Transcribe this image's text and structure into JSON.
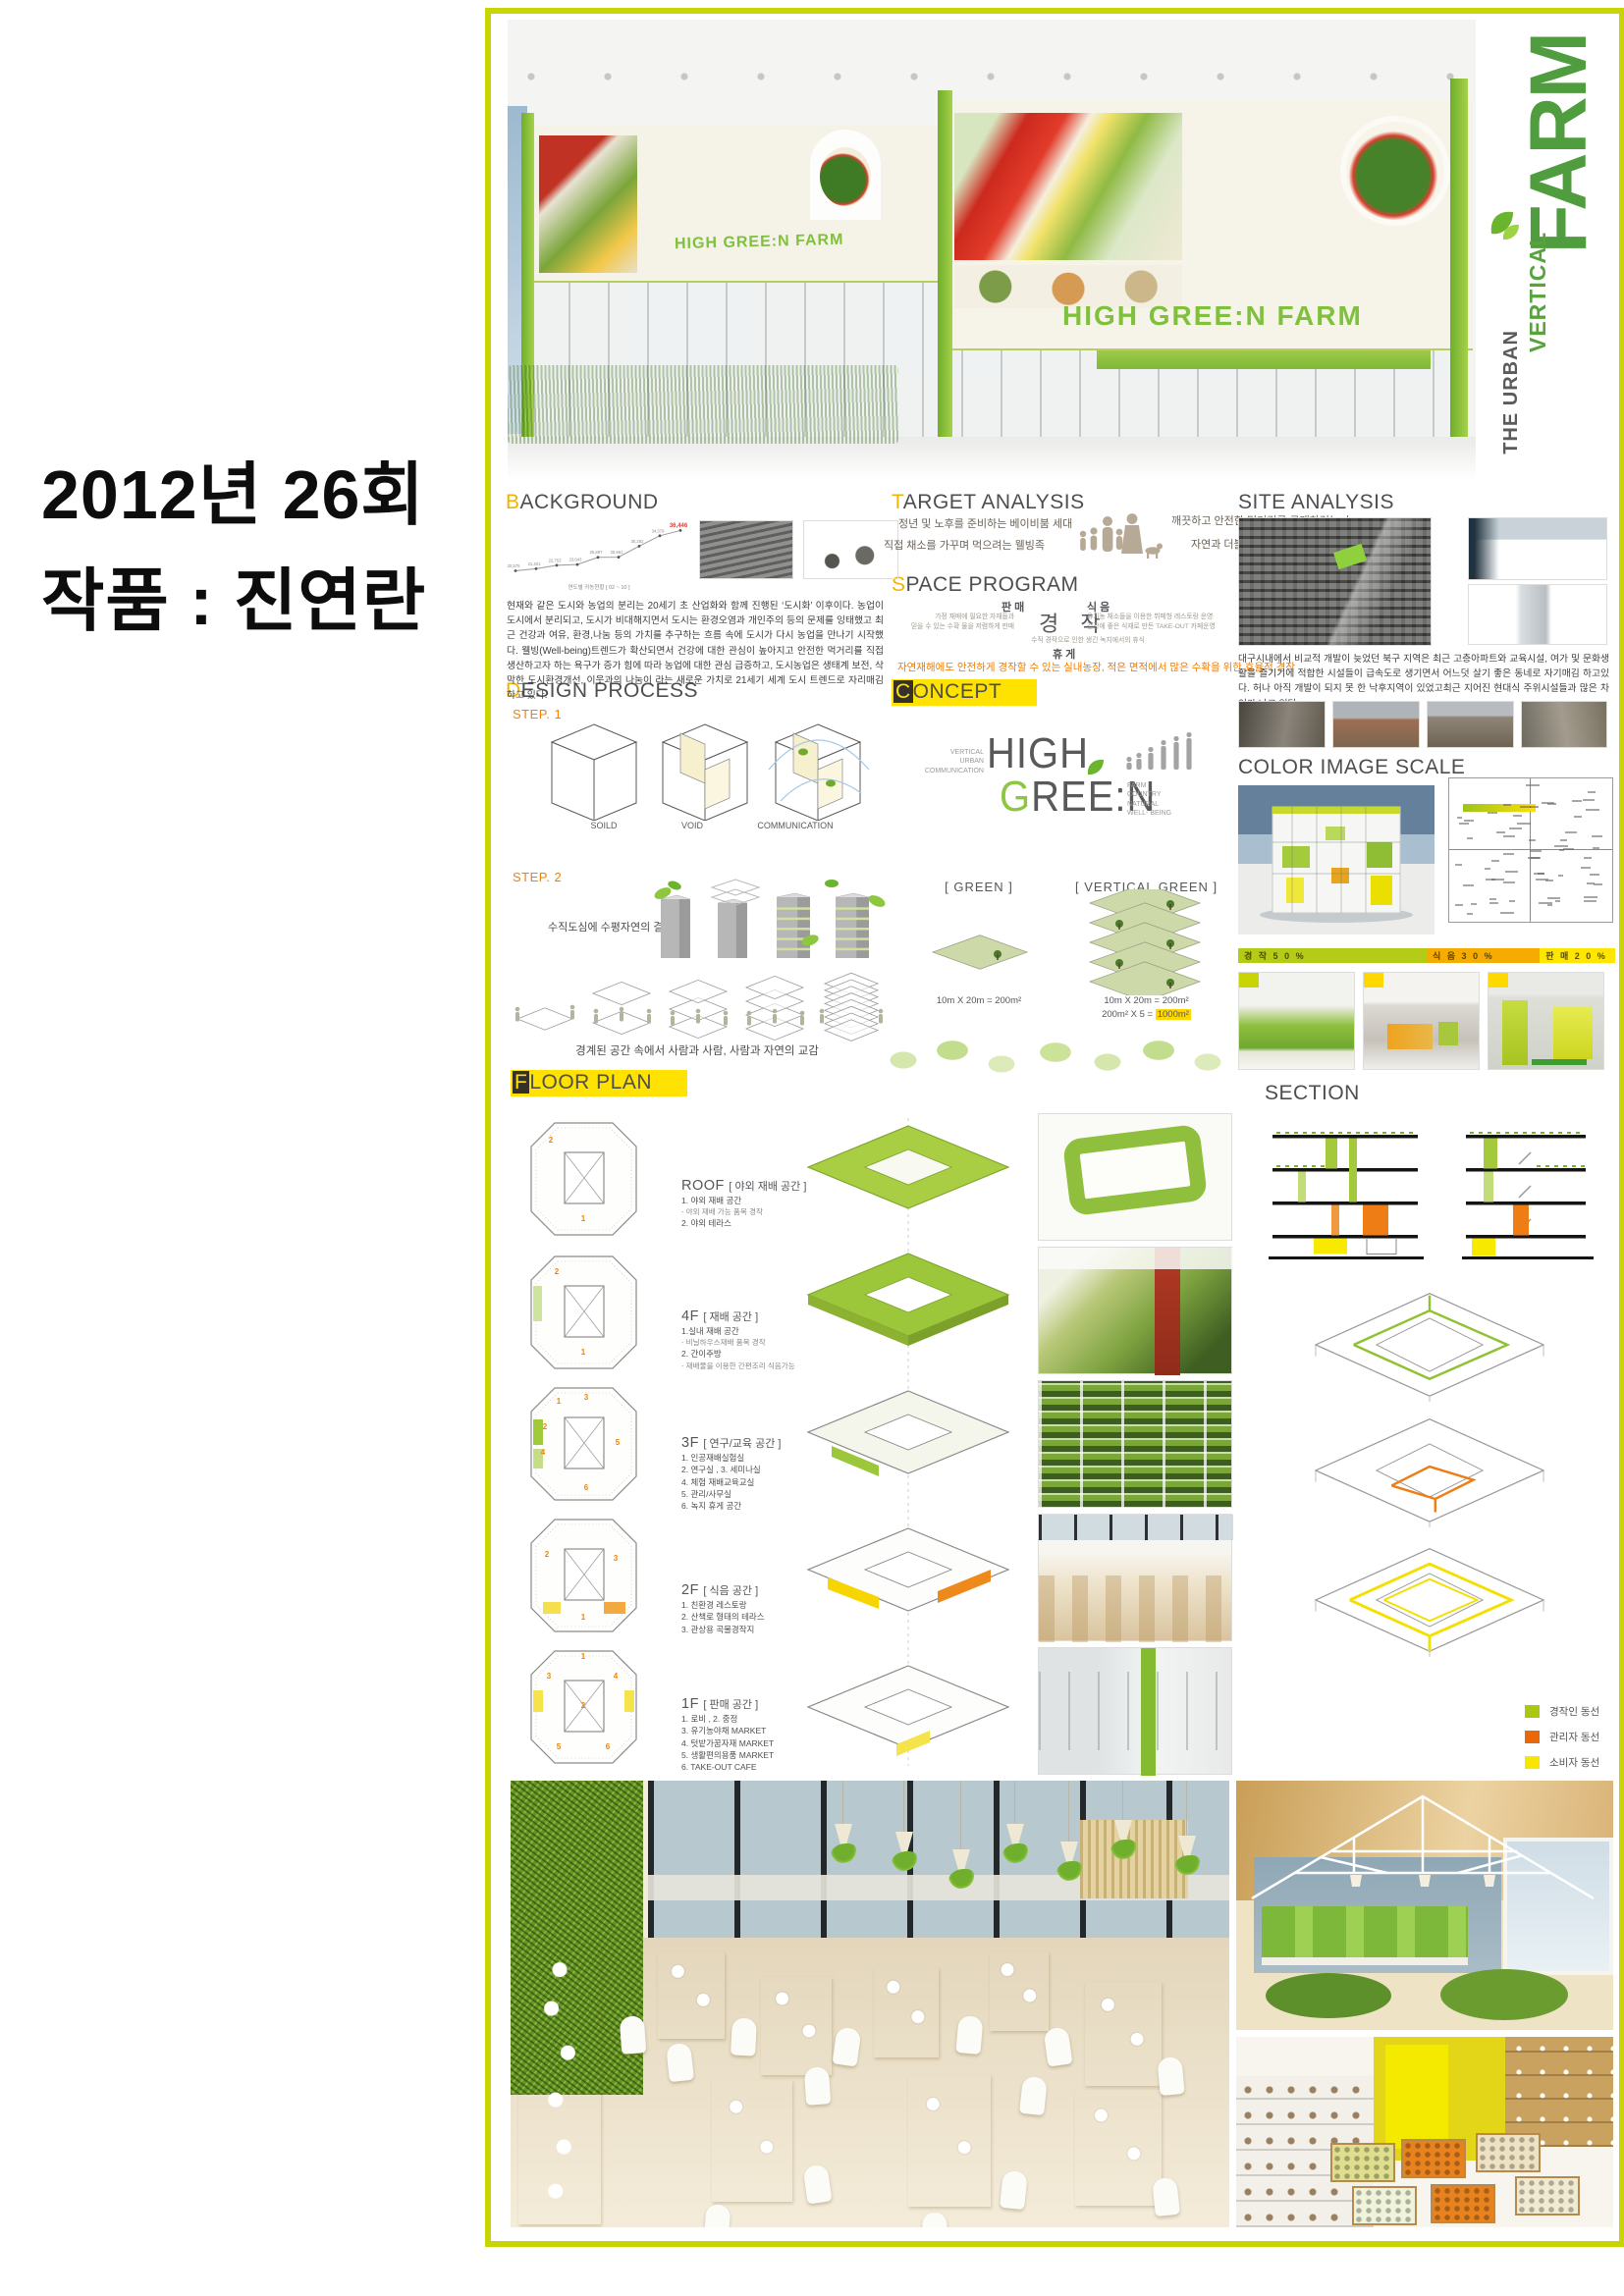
{
  "page": {
    "year_title": "2012년 26회",
    "work_title": "작품 : 진연란"
  },
  "hero": {
    "banner_text_left": "HIGH GREE:N FARM",
    "banner_text_right": "HIGH GREE:N FARM",
    "side_title": {
      "line1": "THE URBAN",
      "line2": "VERTICAL",
      "line3": "FARM"
    }
  },
  "background": {
    "title": "BACKGROUND",
    "chart_caption": "연도별 귀농현황 [ 02 ~ 10 ]",
    "body": "현재와 같은 도시와 농업의 분리는 20세기 초 산업화와 함께 진행된 ‘도시화’ 이후이다. 농업이 도시에서 분리되고, 도시가 비대해지면서 도시는 환경오염과 개인주의 등의 문제를 잉태했고 최근 건강과 여유, 환경,나눔 등의 가치를 추구하는 흐름 속에 도시가 다시 농업을 만나기 시작했다. 웰빙(Well-being)트렌드가 확산되면서 건강에 대한 관심이 높아지고 안전한 먹거리를 직접생산하고자 하는 욕구가 증가 힘에 따라 농업에 대한 관심 급증하고, 도시농업은 생태계 보전, 삭막한 도시환경개선, 이웃과의 나눔이 라는 새로운 가치로 21세기  세계 도시 트렌드로 자리매김 하고 있다."
  },
  "chart_data": {
    "type": "line",
    "title": "연도별 귀농현황 [ 02 ~ 10 ]",
    "x": [
      "02",
      "03",
      "04",
      "05",
      "06",
      "07",
      "08",
      "09",
      "10"
    ],
    "values": [
      20575,
      21401,
      22753,
      23043,
      25897,
      25961,
      30292,
      34379,
      36446
    ],
    "labels": [
      "20,575",
      "21,401",
      "22,753",
      "23,043",
      "25,897",
      "25,961",
      "30,292",
      "34,379",
      "36,446"
    ],
    "ylim": [
      20000,
      37000
    ],
    "grid": false,
    "last_label_color": "#e8392b"
  },
  "target_analysis": {
    "title": "TARGET ANALYSIS",
    "left": [
      "정년 및 노후를 준비하는 베이비붐 세대",
      "직접 채소를 가꾸며 먹으려는 웰빙족"
    ],
    "right": [
      "깨끗하고 안전한 먹거리를 구매하려는 人",
      "자연과 더불어 지내고 싶은 도심거주민"
    ]
  },
  "site_analysis": {
    "title": "SITE ANALYSIS",
    "body": "대구시내에서 비교적 개발이 늦었던 북구 지역은 최근 고층아파트와 교육시설, 여가 및 문화생활을 즐기기에 적합한 시설들이 급속도로 생기면서 어느덧 살기 좋은 동네로 자기매김 하고있다. 허나 아직 개발이 되지 못 한 낙후지역이 있었고최근 지어진 현대식 주위시설들과 많은 차이가 나고 있다."
  },
  "space_program": {
    "title": "SPACE PROGRAM",
    "sale_label": "판 매",
    "sale_desc": "가정 재배에 필요한 자재들과\n믿을 수 있는 수확 물을 저렴하게 판매",
    "farm_label": "경 작",
    "food_label": "식 음",
    "food_desc": "유기농 채소들을 이용한 뷔페형 레스토랑 운영\n건강에 좋은 식재로 만든 TAKE-OUT 카페운영",
    "rest_desc": "수직 경작으로 인한 생긴 녹지에서의 휴식",
    "rest_label": "휴 게",
    "highlight": "자연재해에도 안전하게 경작할 수 있는 실내농장, 적은 면적에서 많은 수확을 위한 효율적 경작"
  },
  "design_process": {
    "title": "DESIGN PROCESS",
    "step1": "STEP. 1",
    "step1_labels": [
      "SOILD",
      "VOID",
      "COMMUNICATION"
    ],
    "step2": "STEP. 2",
    "step2_caption": "수직도심에 수평자연의 결합",
    "interaction_caption": "경계된 공간 속에서 사람과 사람, 사람과 자연의 교감"
  },
  "concept": {
    "title": "CONCEPT",
    "logo": {
      "left": "VERTICAL\nURBAN\nCOMMUNICATION",
      "high": "HIGH",
      "green": "GREE:N",
      "right": "FARM\nCOUNTRY\nNATURAL\nWELL- BEING"
    },
    "green": {
      "label": "[ GREEN ]",
      "calc": "10m X 20m = 200m²"
    },
    "vertical_green": {
      "label": "[ VERTICAL GREEN ]",
      "calc1": "10m X 20m = 200m²",
      "calc2_prefix": "200m²  X  5 = ",
      "calc2_value": "1000m²"
    }
  },
  "color_image_scale": {
    "title": "COLOR IMAGE SCALE",
    "bar": [
      {
        "label": "경 작 5 0 %",
        "color": "#b5cc16",
        "width": 50
      },
      {
        "label": "식 음 3 0 %",
        "color": "#f6ab00",
        "width": 30
      },
      {
        "label": "판 매 2 0 %",
        "color": "#ffe600",
        "width": 20
      }
    ]
  },
  "floor_plan": {
    "title": "FLOOR PLAN",
    "floors": [
      {
        "name": "ROOF",
        "zone": "[ 야외 재배 공간 ]",
        "items": [
          "1. 야외 재배 공간",
          "- 야외 재배 가능 품목 경작",
          "2. 야외 테라스"
        ]
      },
      {
        "name": "4F",
        "zone": "[ 재배 공간 ]",
        "items": [
          "1.실내 재배 공간",
          "- 비닐하우스재배 품목 경작",
          "2. 간이주방",
          "- 재배물을 이용한 간편조리 식음가능"
        ]
      },
      {
        "name": "3F",
        "zone": "[ 연구/교육 공간 ]",
        "items": [
          "1. 인공재배실험실",
          "2. 연구실 , 3. 세미나실",
          "4. 체험 재배교육교실",
          "5. 관리/사무실",
          "6. 녹지 휴게 공간"
        ]
      },
      {
        "name": "2F",
        "zone": "[ 식음 공간 ]",
        "items": [
          "1. 친환경 레스토랑",
          "2. 산책로 형태의 테라스",
          "3. 관상용 곡물경작지"
        ]
      },
      {
        "name": "1F",
        "zone": "[ 판매 공간 ]",
        "items": [
          "1. 로비 , 2. 중정",
          "3. 유기농야채 MARKET",
          "4. 텃밭가꿈자재 MARKET",
          "5. 생활편의용품 MARKET",
          "6. TAKE-OUT CAFE"
        ]
      }
    ]
  },
  "section_view": {
    "title": "SECTION",
    "legend": [
      {
        "label": "경작인 동선",
        "color": "#a8c814"
      },
      {
        "label": "관리자 동선",
        "color": "#e8680b"
      },
      {
        "label": "소비자 동선",
        "color": "#f7e600"
      }
    ]
  },
  "colors": {
    "poster_border": "#c8d404",
    "accent_yellow": "#ffe200",
    "accent_gold": "#f0b400",
    "accent_orange": "#f08300",
    "brand_green": "#8dc63f",
    "deep_green": "#4f9d3f"
  }
}
